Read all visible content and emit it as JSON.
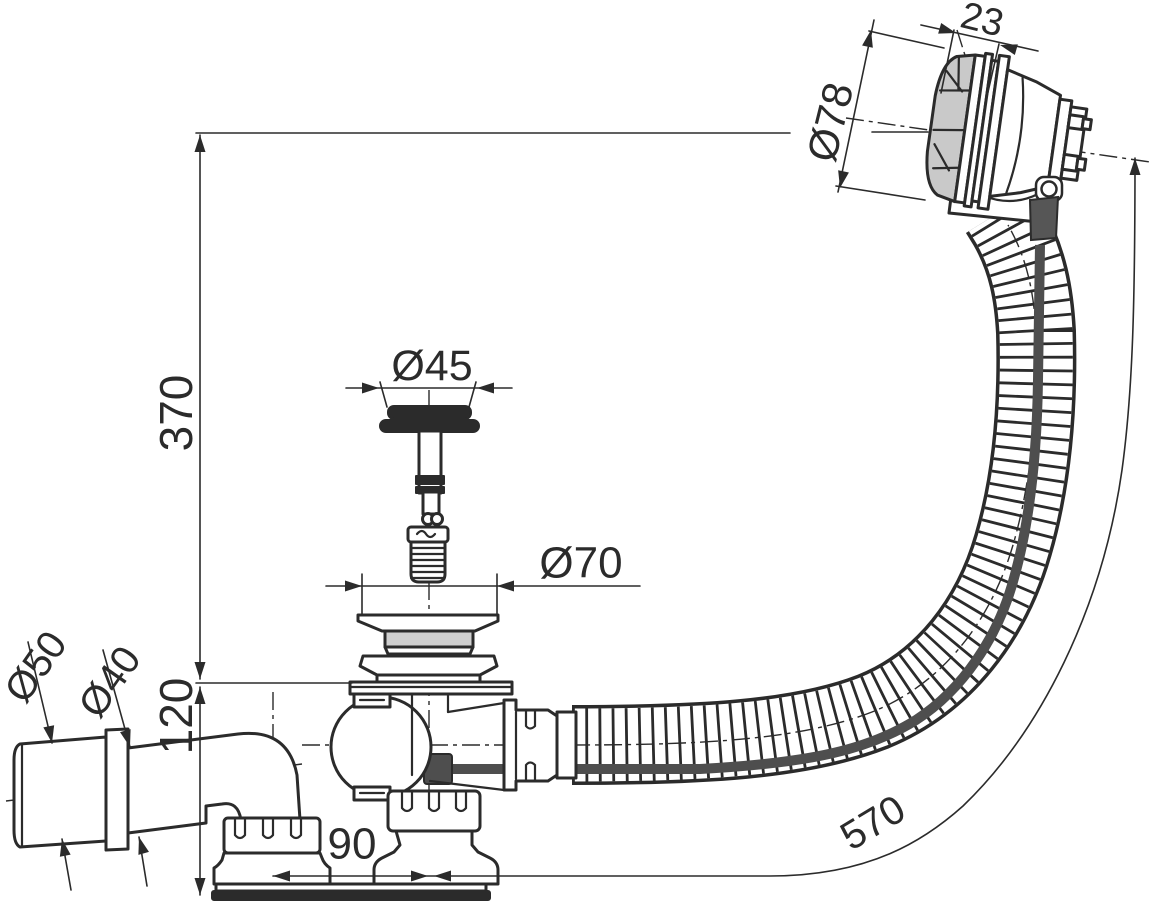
{
  "drawing": {
    "type": "technical-dimension-drawing",
    "subject": "bath-waste-and-overflow-set-with-flexible-hose"
  },
  "palette": {
    "line": "#2b2b2b",
    "light_fill": "#cfcfcf",
    "knob_fill": "#c9c9c9",
    "cable": "#4e4e4e",
    "background": "#ffffff"
  },
  "dimensions": {
    "knob_width": {
      "label": "23",
      "value_mm": 23
    },
    "knob_diameter": {
      "label": "Ø78",
      "value_mm": 78
    },
    "overflow_height": {
      "label": "370",
      "value_mm": 370
    },
    "plug_diameter": {
      "label": "Ø45",
      "value_mm": 45
    },
    "flange_diameter": {
      "label": "Ø70",
      "value_mm": 70
    },
    "base_height": {
      "label": "120",
      "value_mm": 120
    },
    "outlet_outer_diameter": {
      "label": "Ø50",
      "value_mm": 50
    },
    "outlet_pipe_diameter": {
      "label": "Ø40",
      "value_mm": 40
    },
    "outlet_offset": {
      "label": "90",
      "value_mm": 90
    },
    "hose_length": {
      "label": "570",
      "value_mm": 570
    }
  }
}
